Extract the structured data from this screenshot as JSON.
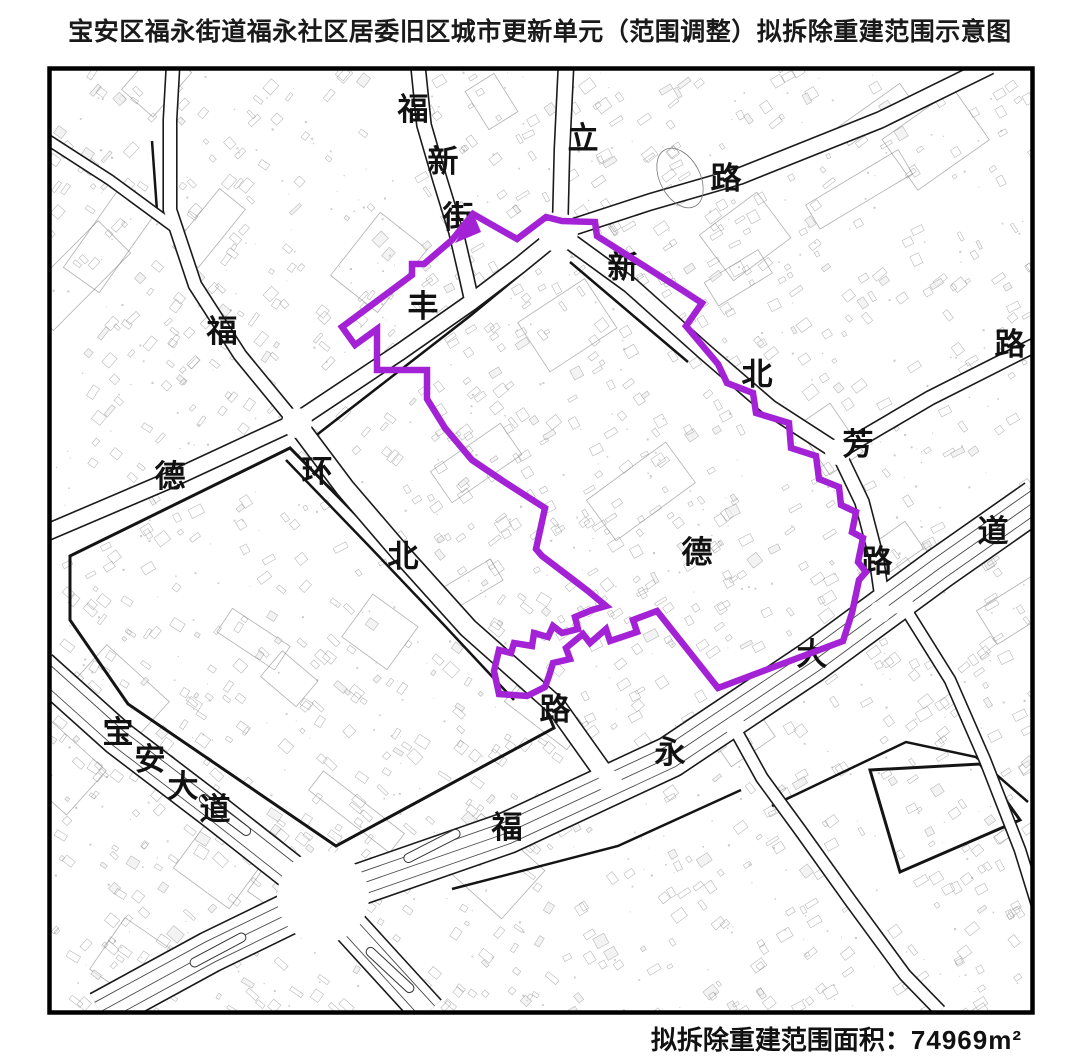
{
  "title": "宝安区福永街道福永社区居委旧区城市更新单元（范围调整）拟拆除重建范围示意图",
  "footer": {
    "label": "拟拆除重建范围面积：",
    "value": "74969",
    "unit": "m²"
  },
  "colors": {
    "boundary": "#A322D6",
    "road_edge": "#1a1a1a",
    "text": "#111111",
    "parcel": "#8a8a8a",
    "background": "#ffffff"
  },
  "map": {
    "origin": {
      "x": 47,
      "y": 66
    },
    "width": 988,
    "height": 949,
    "border_width": 4.5,
    "road_labels": [
      {
        "char": "福",
        "x": 413,
        "y": 110
      },
      {
        "char": "新",
        "x": 443,
        "y": 162
      },
      {
        "char": "街",
        "x": 458,
        "y": 218
      },
      {
        "char": "立",
        "x": 583,
        "y": 139
      },
      {
        "char": "路",
        "x": 726,
        "y": 179
      },
      {
        "char": "新",
        "x": 623,
        "y": 268
      },
      {
        "char": "丰",
        "x": 423,
        "y": 307
      },
      {
        "char": "福",
        "x": 222,
        "y": 332
      },
      {
        "char": "路",
        "x": 1010,
        "y": 345
      },
      {
        "char": "北",
        "x": 757,
        "y": 375
      },
      {
        "char": "芳",
        "x": 858,
        "y": 445
      },
      {
        "char": "环",
        "x": 317,
        "y": 472
      },
      {
        "char": "德",
        "x": 170,
        "y": 477
      },
      {
        "char": "道",
        "x": 993,
        "y": 532
      },
      {
        "char": "德",
        "x": 697,
        "y": 553
      },
      {
        "char": "北",
        "x": 403,
        "y": 557
      },
      {
        "char": "路",
        "x": 877,
        "y": 562
      },
      {
        "char": "大",
        "x": 812,
        "y": 655
      },
      {
        "char": "路",
        "x": 555,
        "y": 710
      },
      {
        "char": "宝",
        "x": 118,
        "y": 733
      },
      {
        "char": "永",
        "x": 670,
        "y": 753
      },
      {
        "char": "安",
        "x": 150,
        "y": 760
      },
      {
        "char": "大",
        "x": 183,
        "y": 787
      },
      {
        "char": "道",
        "x": 215,
        "y": 810
      },
      {
        "char": "福",
        "x": 507,
        "y": 828
      }
    ],
    "roads": [
      {
        "id": "baoan-blvd",
        "points": [
          [
            40,
            668
          ],
          [
            118,
            738
          ],
          [
            215,
            812
          ],
          [
            323,
            897
          ],
          [
            428,
            1012
          ]
        ],
        "width": 34,
        "lanes": [
          -9,
          9
        ]
      },
      {
        "id": "fuyong-blvd",
        "points": [
          [
            100,
            1012
          ],
          [
            210,
            952
          ],
          [
            323,
            897
          ],
          [
            507,
            833
          ],
          [
            670,
            757
          ],
          [
            812,
            662
          ],
          [
            940,
            568
          ],
          [
            1037,
            500
          ]
        ],
        "width": 40,
        "lanes": [
          -11,
          0,
          11
        ]
      },
      {
        "id": "fuxin-street",
        "points": [
          [
            418,
            66
          ],
          [
            424,
            125
          ],
          [
            440,
            180
          ],
          [
            456,
            232
          ],
          [
            466,
            275
          ],
          [
            472,
            302
          ]
        ],
        "width": 13,
        "lanes": []
      },
      {
        "id": "north-approach",
        "points": [
          [
            566,
            66
          ],
          [
            562,
            150
          ],
          [
            560,
            232
          ]
        ],
        "width": 14,
        "lanes": []
      },
      {
        "id": "lixin-road-ne",
        "points": [
          [
            558,
            232
          ],
          [
            650,
            202
          ],
          [
            740,
            176
          ],
          [
            880,
            120
          ],
          [
            990,
            66
          ]
        ],
        "width": 15,
        "lanes": []
      },
      {
        "id": "fengde-road",
        "points": [
          [
            48,
            532
          ],
          [
            170,
            480
          ],
          [
            295,
            422
          ],
          [
            400,
            352
          ],
          [
            470,
            303
          ],
          [
            520,
            265
          ],
          [
            558,
            234
          ]
        ],
        "width": 15,
        "lanes": []
      },
      {
        "id": "fu-road-nw",
        "points": [
          [
            295,
            422
          ],
          [
            240,
            355
          ],
          [
            195,
            285
          ],
          [
            170,
            210
          ],
          [
            170,
            120
          ],
          [
            173,
            66
          ]
        ],
        "width": 12,
        "lanes": []
      },
      {
        "id": "fu-road-branch",
        "points": [
          [
            178,
            230
          ],
          [
            110,
            180
          ],
          [
            48,
            140
          ]
        ],
        "width": 9,
        "lanes": []
      },
      {
        "id": "huanbei-road",
        "points": [
          [
            297,
            424
          ],
          [
            345,
            488
          ],
          [
            405,
            558
          ],
          [
            468,
            628
          ],
          [
            556,
            706
          ],
          [
            610,
            782
          ]
        ],
        "width": 18,
        "lanes": []
      },
      {
        "id": "xinbei-road",
        "points": [
          [
            560,
            234
          ],
          [
            630,
            285
          ],
          [
            705,
            352
          ],
          [
            770,
            408
          ],
          [
            838,
            452
          ]
        ],
        "width": 15,
        "lanes": []
      },
      {
        "id": "xinbei-road-ne",
        "points": [
          [
            838,
            452
          ],
          [
            930,
            398
          ],
          [
            1037,
            344
          ]
        ],
        "width": 13,
        "lanes": []
      },
      {
        "id": "fang-road-s",
        "points": [
          [
            838,
            452
          ],
          [
            862,
            502
          ],
          [
            876,
            556
          ],
          [
            884,
            612
          ]
        ],
        "width": 13,
        "lanes": []
      },
      {
        "id": "south-east-road",
        "points": [
          [
            731,
            722
          ],
          [
            762,
            778
          ],
          [
            800,
            830
          ],
          [
            850,
            900
          ],
          [
            905,
            975
          ],
          [
            940,
            1011
          ]
        ],
        "width": 11,
        "lanes": []
      },
      {
        "id": "east-road",
        "points": [
          [
            905,
            608
          ],
          [
            950,
            680
          ],
          [
            985,
            760
          ],
          [
            1020,
            850
          ],
          [
            1037,
            905
          ]
        ],
        "width": 10,
        "lanes": []
      }
    ],
    "junctions": [
      {
        "x": 323,
        "y": 897,
        "r": 46
      },
      {
        "x": 558,
        "y": 232,
        "r": 20
      },
      {
        "x": 297,
        "y": 423,
        "r": 15
      },
      {
        "x": 838,
        "y": 452,
        "r": 13
      },
      {
        "x": 610,
        "y": 782,
        "r": 12
      },
      {
        "x": 880,
        "y": 612,
        "r": 11
      },
      {
        "x": 735,
        "y": 726,
        "r": 10
      },
      {
        "x": 905,
        "y": 608,
        "r": 10
      }
    ],
    "medians": [
      {
        "x": 225,
        "y": 815,
        "angle": 37
      },
      {
        "x": 390,
        "y": 970,
        "angle": 43
      },
      {
        "x": 218,
        "y": 950,
        "angle": -28
      },
      {
        "x": 432,
        "y": 846,
        "angle": -27
      }
    ],
    "thick_outlines": [
      {
        "closed": false,
        "points": [
          [
            305,
            444
          ],
          [
            470,
            316
          ],
          [
            548,
            252
          ]
        ]
      },
      {
        "closed": false,
        "points": [
          [
            570,
            262
          ],
          [
            636,
            318
          ],
          [
            688,
            362
          ]
        ]
      },
      {
        "closed": false,
        "points": [
          [
            286,
            460
          ],
          [
            368,
            545
          ],
          [
            444,
            625
          ],
          [
            514,
            700
          ]
        ]
      },
      {
        "closed": true,
        "points": [
          [
            70,
            556
          ],
          [
            290,
            448
          ],
          [
            545,
            706
          ],
          [
            554,
            728
          ],
          [
            336,
            846
          ],
          [
            128,
            704
          ],
          [
            70,
            620
          ]
        ]
      },
      {
        "closed": false,
        "points": [
          [
            452,
            889
          ],
          [
            618,
            846
          ],
          [
            741,
            790
          ]
        ]
      },
      {
        "closed": false,
        "points": [
          [
            772,
            806
          ],
          [
            906,
            742
          ],
          [
            976,
            757
          ],
          [
            1028,
            802
          ]
        ]
      },
      {
        "closed": false,
        "points": [
          [
            152,
            141
          ],
          [
            157,
            211
          ]
        ]
      },
      {
        "closed": false,
        "points": [
          [
            735,
            695
          ],
          [
            855,
            635
          ],
          [
            880,
            620
          ]
        ]
      },
      {
        "closed": true,
        "points": [
          [
            870,
            770
          ],
          [
            980,
            764
          ],
          [
            1020,
            820
          ],
          [
            900,
            872
          ]
        ]
      }
    ],
    "boundary": {
      "stroke_width": 6.5,
      "arrowhead": [
        [
          473,
          213
        ],
        [
          455,
          243
        ],
        [
          481,
          232
        ]
      ],
      "points": [
        [
          342,
          327
        ],
        [
          412,
          275
        ],
        [
          412,
          264
        ],
        [
          424,
          264
        ],
        [
          452,
          240
        ],
        [
          473,
          214
        ],
        [
          517,
          239
        ],
        [
          546,
          217
        ],
        [
          562,
          221
        ],
        [
          595,
          222
        ],
        [
          597,
          236
        ],
        [
          682,
          290
        ],
        [
          702,
          303
        ],
        [
          686,
          326
        ],
        [
          718,
          364
        ],
        [
          727,
          383
        ],
        [
          753,
          393
        ],
        [
          756,
          413
        ],
        [
          789,
          423
        ],
        [
          791,
          448
        ],
        [
          816,
          456
        ],
        [
          819,
          479
        ],
        [
          839,
          487
        ],
        [
          841,
          505
        ],
        [
          856,
          512
        ],
        [
          852,
          532
        ],
        [
          863,
          538
        ],
        [
          858,
          562
        ],
        [
          866,
          572
        ],
        [
          859,
          580
        ],
        [
          852,
          613
        ],
        [
          843,
          641
        ],
        [
          718,
          688
        ],
        [
          657,
          611
        ],
        [
          633,
          620
        ],
        [
          637,
          632
        ],
        [
          610,
          641
        ],
        [
          606,
          629
        ],
        [
          590,
          643
        ],
        [
          583,
          634
        ],
        [
          566,
          648
        ],
        [
          570,
          659
        ],
        [
          553,
          663
        ],
        [
          549,
          676
        ],
        [
          545,
          687
        ],
        [
          527,
          696
        ],
        [
          499,
          694
        ],
        [
          494,
          671
        ],
        [
          499,
          650
        ],
        [
          511,
          653
        ],
        [
          514,
          643
        ],
        [
          532,
          646
        ],
        [
          534,
          633
        ],
        [
          548,
          637
        ],
        [
          553,
          626
        ],
        [
          562,
          633
        ],
        [
          578,
          629
        ],
        [
          575,
          617
        ],
        [
          592,
          610
        ],
        [
          606,
          606
        ],
        [
          588,
          591
        ],
        [
          571,
          578
        ],
        [
          542,
          556
        ],
        [
          536,
          549
        ],
        [
          545,
          508
        ],
        [
          503,
          481
        ],
        [
          472,
          460
        ],
        [
          445,
          428
        ],
        [
          427,
          399
        ],
        [
          427,
          370
        ],
        [
          377,
          370
        ],
        [
          377,
          329
        ],
        [
          355,
          345
        ]
      ]
    }
  }
}
